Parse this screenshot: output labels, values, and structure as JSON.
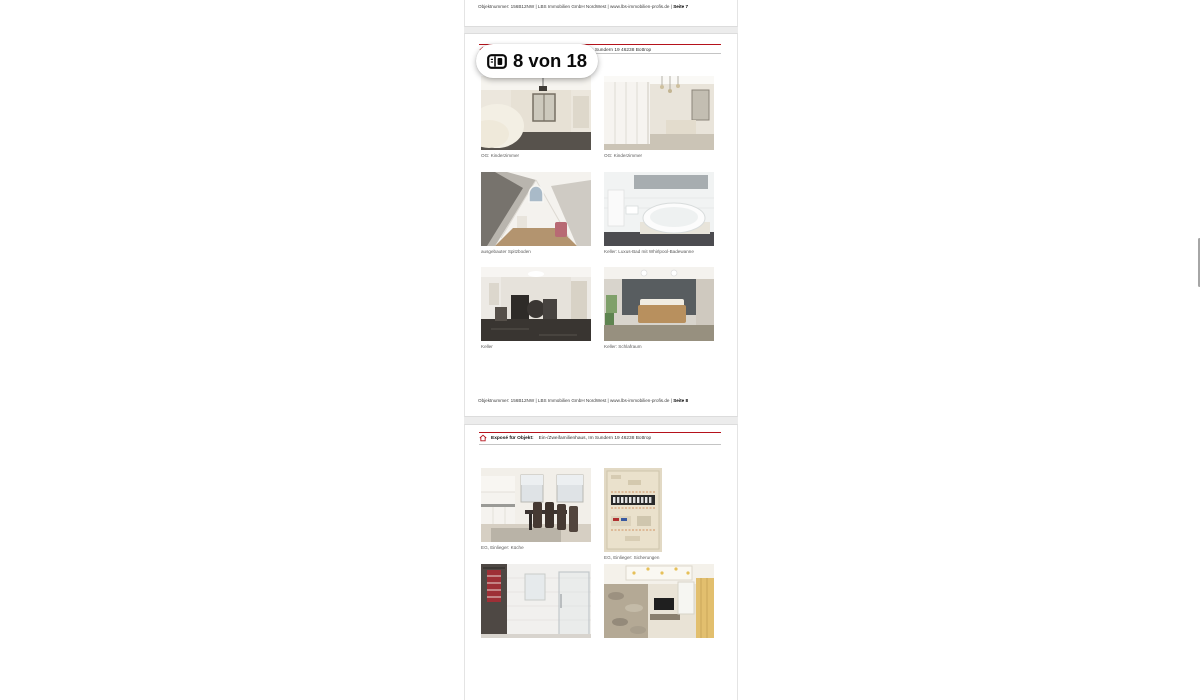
{
  "viewer": {
    "page_indicator": {
      "label": "8 von 18",
      "icon": "page-counter-icon"
    },
    "scrollbar": {
      "thumb_color": "#a6a6a6"
    }
  },
  "branding": {
    "accent_red": "#b5121b",
    "logo_icon": "lbs-house-logo"
  },
  "header": {
    "label": "Exposé für Objekt:",
    "address": "Ein-/Zweifamilienhaus, Im Sundern 19 46238 Bottrop"
  },
  "footer": {
    "base": "Objektnummer: 156B12NW   | LBS Immobilien GmbH NordWest | www.lbs-immobilien-profis.de |",
    "page7_label": "Seite 7",
    "page8_label": "Seite 8"
  },
  "page8": {
    "photos": [
      {
        "name": "og-kinderzimmer-1",
        "caption": "OG: Kinderzimmer"
      },
      {
        "name": "og-kinderzimmer-2",
        "caption": "OG: Kinderzimmer"
      },
      {
        "name": "ausgebauter-spitzboden",
        "caption": "ausgebauter Spitzboden"
      },
      {
        "name": "keller-luxus-bad",
        "caption": "Keller: Luxus-Bad mit Whirlpool-Badewanne"
      },
      {
        "name": "keller",
        "caption": "Keller"
      },
      {
        "name": "keller-schlafraum",
        "caption": "Keller: Schlafraum"
      }
    ]
  },
  "page9": {
    "photos": [
      {
        "name": "eg-einlieger-kueche",
        "caption": "EG, Einlieger: Küche"
      },
      {
        "name": "eg-einlieger-sicherungen",
        "caption": "EG, Einlieger: Sicherungen"
      },
      {
        "name": "eg-einlieger-bad",
        "caption": ""
      },
      {
        "name": "eg-wohnzimmer",
        "caption": ""
      }
    ]
  }
}
